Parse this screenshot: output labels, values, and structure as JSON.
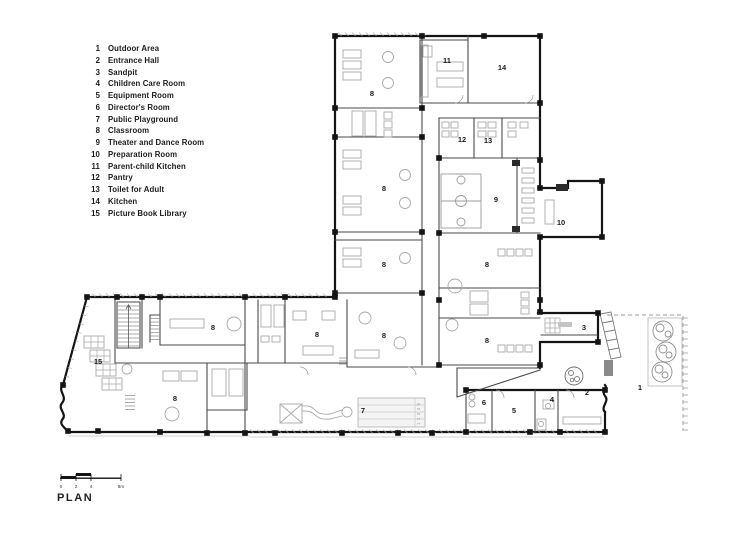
{
  "legend": {
    "items": [
      {
        "num": "1",
        "label": "Outdoor Area"
      },
      {
        "num": "2",
        "label": "Entrance Hall"
      },
      {
        "num": "3",
        "label": "Sandpit"
      },
      {
        "num": "4",
        "label": "Children Care Room"
      },
      {
        "num": "5",
        "label": "Equipment Room"
      },
      {
        "num": "6",
        "label": "Director's Room"
      },
      {
        "num": "7",
        "label": "Public Playground"
      },
      {
        "num": "8",
        "label": "Classroom"
      },
      {
        "num": "9",
        "label": "Theater and Dance Room"
      },
      {
        "num": "10",
        "label": "Preparation Room"
      },
      {
        "num": "11",
        "label": "Parent-child Kitchen"
      },
      {
        "num": "12",
        "label": "Pantry"
      },
      {
        "num": "13",
        "label": "Toilet for Adult"
      },
      {
        "num": "14",
        "label": "Kitchen"
      },
      {
        "num": "15",
        "label": "Picture Book Library"
      }
    ]
  },
  "plan": {
    "room_labels": [
      {
        "num": "8",
        "x": 372,
        "y": 96
      },
      {
        "num": "11",
        "x": 447,
        "y": 63
      },
      {
        "num": "14",
        "x": 502,
        "y": 70
      },
      {
        "num": "12",
        "x": 462,
        "y": 142
      },
      {
        "num": "13",
        "x": 488,
        "y": 143
      },
      {
        "num": "8",
        "x": 384,
        "y": 191
      },
      {
        "num": "9",
        "x": 496,
        "y": 202
      },
      {
        "num": "10",
        "x": 561,
        "y": 225
      },
      {
        "num": "8",
        "x": 384,
        "y": 267
      },
      {
        "num": "8",
        "x": 487,
        "y": 267
      },
      {
        "num": "8",
        "x": 213,
        "y": 330
      },
      {
        "num": "8",
        "x": 317,
        "y": 337
      },
      {
        "num": "8",
        "x": 384,
        "y": 338
      },
      {
        "num": "8",
        "x": 487,
        "y": 343
      },
      {
        "num": "15",
        "x": 98,
        "y": 364
      },
      {
        "num": "8",
        "x": 175,
        "y": 401
      },
      {
        "num": "7",
        "x": 363,
        "y": 413
      },
      {
        "num": "6",
        "x": 484,
        "y": 405
      },
      {
        "num": "5",
        "x": 514,
        "y": 413
      },
      {
        "num": "4",
        "x": 552,
        "y": 402
      },
      {
        "num": "2",
        "x": 587,
        "y": 395
      },
      {
        "num": "3",
        "x": 584,
        "y": 330
      },
      {
        "num": "1",
        "x": 640,
        "y": 390
      }
    ],
    "height_ruler_text": "1 2 3 4 5"
  },
  "scale_bar": {
    "ticks": [
      {
        "label": "0",
        "x": 61
      },
      {
        "label": "2",
        "x": 76
      },
      {
        "label": "4",
        "x": 91
      },
      {
        "label": "8m",
        "x": 121
      }
    ]
  },
  "title": "PLAN",
  "colors": {
    "ink": "#141414",
    "wall_light": "#555555",
    "furniture": "#a8a8a8",
    "hatch": "#999999"
  }
}
